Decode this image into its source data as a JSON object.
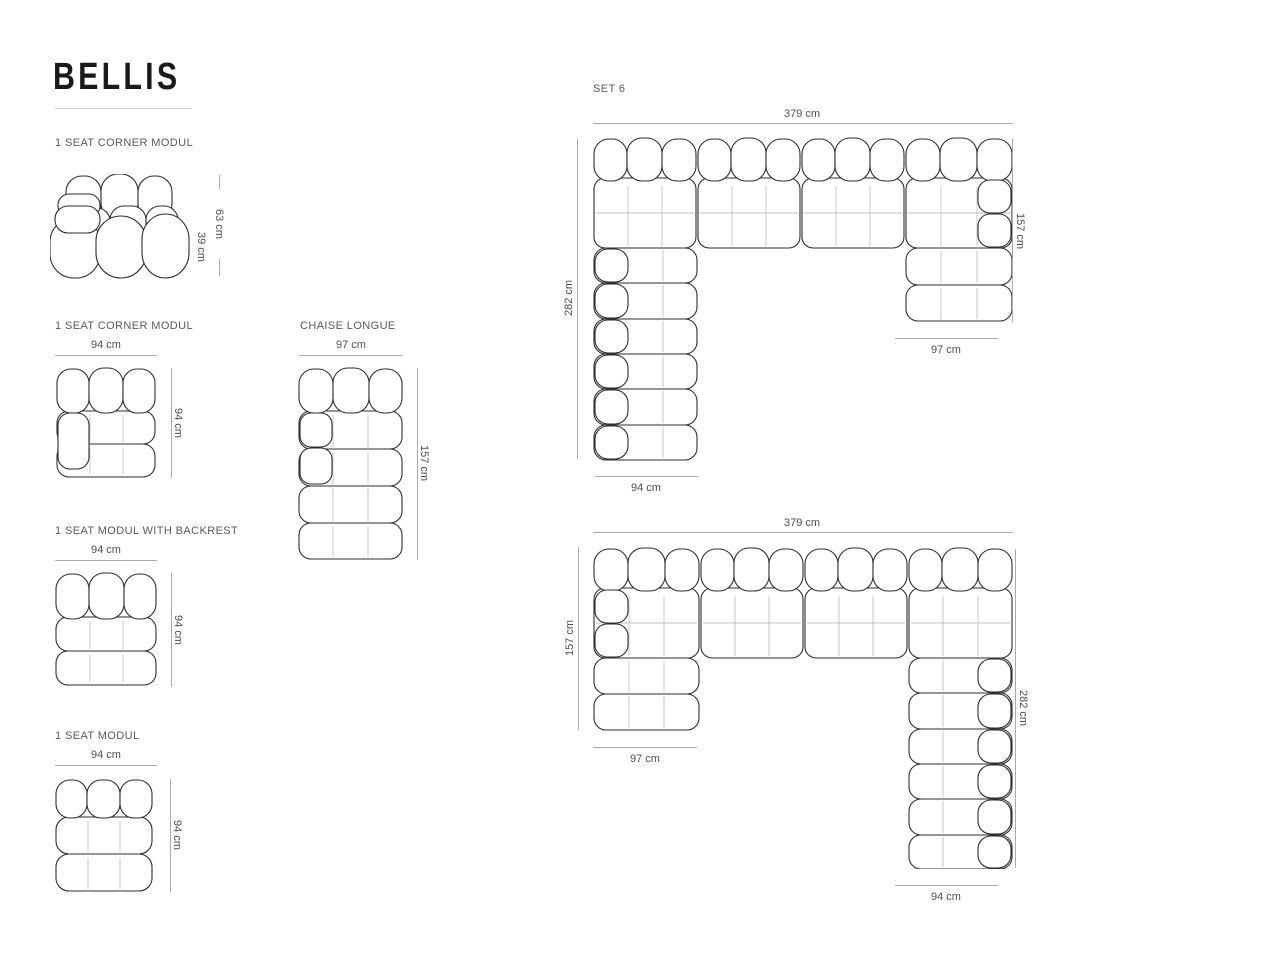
{
  "brand": {
    "title": "BELLIS"
  },
  "sections": {
    "side_module": {
      "label": "1 SEAT CORNER MODUL",
      "total_height": "63 cm",
      "seat_height": "39 cm"
    },
    "corner_module": {
      "label": "1 SEAT CORNER MODUL",
      "width": "94 cm",
      "depth": "94 cm"
    },
    "chaise": {
      "label": "CHAISE LONGUE",
      "width": "97 cm",
      "depth": "157 cm"
    },
    "backrest_module": {
      "label": "1 SEAT MODUL WITH BACKREST",
      "width": "94 cm",
      "depth": "94 cm"
    },
    "seat_module": {
      "label": "1 SEAT MODUL",
      "width": "94 cm",
      "depth": "94 cm"
    },
    "set6": {
      "label": "SET 6",
      "config1": {
        "width_top": "379 cm",
        "depth_left": "282 cm",
        "depth_right": "157 cm",
        "width_bottom_left": "94 cm",
        "width_bottom_right": "97 cm"
      },
      "config2": {
        "width_top": "379 cm",
        "depth_left": "157 cm",
        "depth_right": "282 cm",
        "width_bottom_left": "97 cm",
        "width_bottom_right": "94 cm"
      }
    }
  },
  "colors": {
    "outline": "#2e2e2e",
    "grid_line": "#c2c2c2",
    "dim_line": "#ababab",
    "label_text": "#5b5b5b",
    "dim_text": "#4f4f4f",
    "title_text": "#1a1a1a"
  }
}
